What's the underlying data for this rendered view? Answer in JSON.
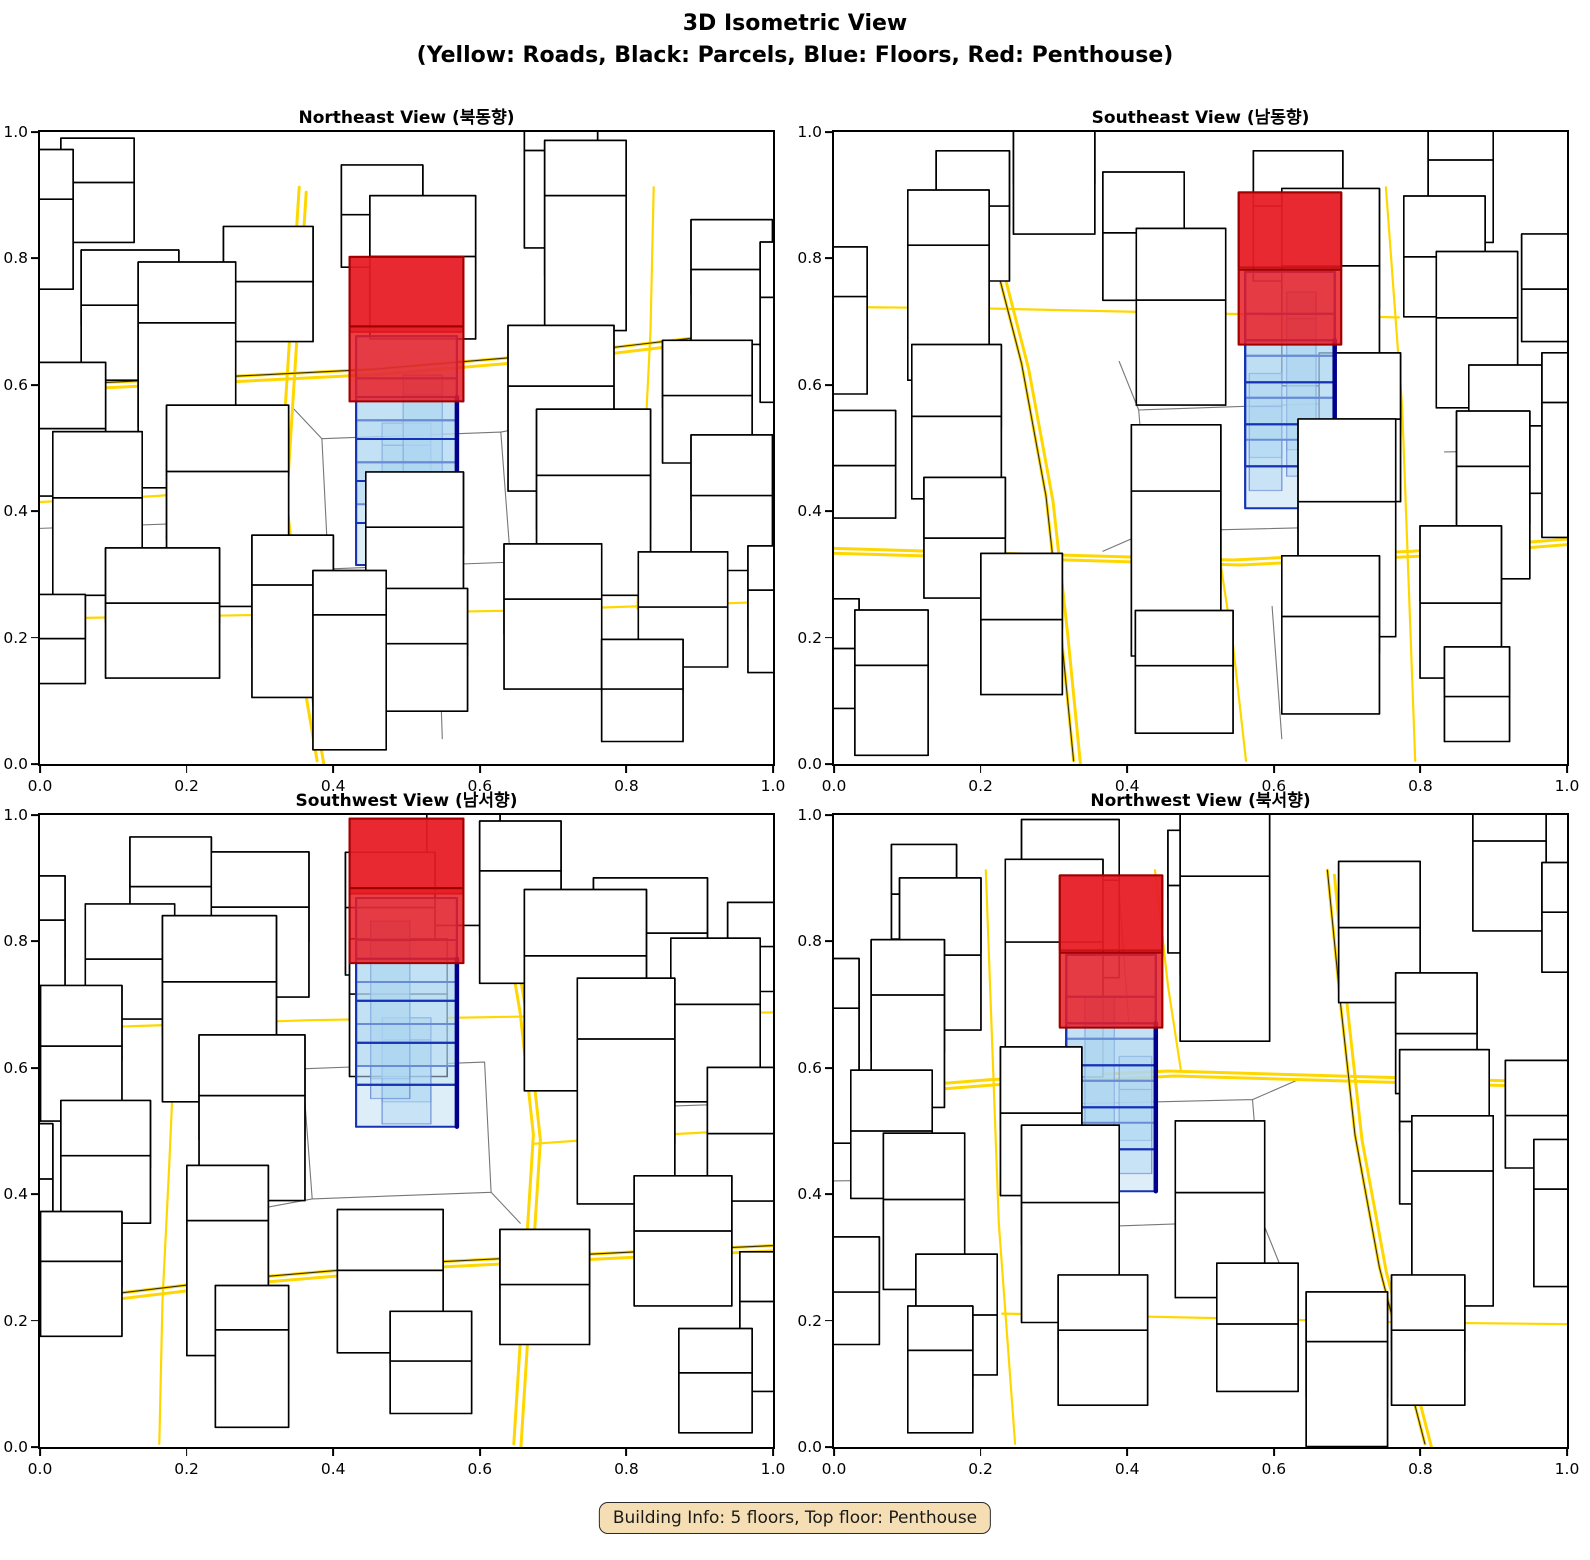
{
  "figure": {
    "suptitle_line1": "3D Isometric View",
    "suptitle_line2": "(Yellow: Roads, Black: Parcels, Blue: Floors, Red: Penthouse)",
    "annotation": "Building Info: 5 floors, Top floor: Penthouse"
  },
  "building_info": {
    "floors": 5,
    "top_floor": "Penthouse"
  },
  "axis": {
    "ticks": [
      "0.0",
      "0.2",
      "0.4",
      "0.6",
      "0.8",
      "1.0"
    ]
  },
  "panels": [
    {
      "id": "northeast",
      "title": "Northeast View (북동향)",
      "azimuth": 45
    },
    {
      "id": "southeast",
      "title": "Southeast View (남동향)",
      "azimuth": 135
    },
    {
      "id": "southwest",
      "title": "Southwest View (남서향)",
      "azimuth": 225
    },
    {
      "id": "northwest",
      "title": "Northwest View (북서향)",
      "azimuth": 315
    }
  ],
  "colors": {
    "road": "#FFD700",
    "parcel": "#777777",
    "parcel_dark": "#3a3000",
    "building_fill": "#ffffff",
    "building_edge": "#000000",
    "floor_fill": "#AED6F1",
    "floor_edge": "#1733B5",
    "floor_edge_dark": "#00008B",
    "penthouse_fill": "#E81C24",
    "penthouse_edge": "#A00000",
    "annotation_bg": "#F5DEB3"
  },
  "scene": {
    "center_building": {
      "x": 0,
      "y": 0.55,
      "w": 0.62,
      "d": 0.55,
      "floors": 4,
      "floor_h": 0.28,
      "pent_h": 0.5,
      "pent_overhang": 0.08
    },
    "annexes": [
      [
        0.0,
        0.4,
        0.3,
        0.2,
        0.56
      ],
      [
        0.1,
        0.62,
        0.24,
        0.18,
        1.05
      ]
    ],
    "buildings": [
      [
        -1.5,
        1.6,
        0.7,
        0.5,
        0.5
      ],
      [
        -0.7,
        1.8,
        0.5,
        0.45,
        0.75
      ],
      [
        0.1,
        1.9,
        0.55,
        0.5,
        0.45
      ],
      [
        0.9,
        1.7,
        0.6,
        0.5,
        0.6
      ],
      [
        1.7,
        1.5,
        0.55,
        0.5,
        0.4
      ],
      [
        -1.9,
        0.8,
        0.55,
        0.6,
        0.65
      ],
      [
        -1.1,
        0.9,
        0.75,
        0.6,
        0.9
      ],
      [
        0.05,
        0.98,
        0.6,
        0.5,
        0.55
      ],
      [
        1.15,
        0.8,
        0.7,
        0.6,
        0.8
      ],
      [
        2.0,
        0.6,
        0.5,
        0.55,
        0.5
      ],
      [
        -2.1,
        -0.1,
        0.5,
        0.6,
        0.45
      ],
      [
        -1.35,
        -0.15,
        0.6,
        0.55,
        1.1
      ],
      [
        0.95,
        -0.12,
        0.65,
        0.55,
        0.7
      ],
      [
        1.85,
        -0.35,
        0.55,
        0.5,
        0.45
      ],
      [
        -1.7,
        -1.1,
        0.6,
        0.5,
        0.5
      ],
      [
        -0.85,
        -1.45,
        0.55,
        0.5,
        0.4
      ],
      [
        0.1,
        -1.5,
        0.65,
        0.55,
        0.55
      ],
      [
        1.1,
        -1.55,
        0.5,
        0.5,
        0.9
      ],
      [
        2.0,
        -1.4,
        0.5,
        0.45,
        0.5
      ],
      [
        -0.15,
        -2.1,
        0.5,
        0.45,
        0.35
      ],
      [
        -2.2,
        1.7,
        0.45,
        0.4,
        0.3
      ],
      [
        2.3,
        1.6,
        0.4,
        0.4,
        0.55
      ],
      [
        -2.3,
        -1.9,
        0.5,
        0.45,
        0.6
      ],
      [
        0.95,
        -2.25,
        0.45,
        0.4,
        0.65
      ],
      [
        -0.35,
        2.3,
        0.45,
        0.4,
        0.9
      ],
      [
        1.45,
        2.2,
        0.5,
        0.45,
        0.35
      ],
      [
        -1.9,
        -2.3,
        0.45,
        0.4,
        0.4
      ],
      [
        2.4,
        -0.9,
        0.45,
        0.5,
        0.7
      ]
    ],
    "roads": [
      {
        "double": true,
        "pts": [
          [
            -2.6,
            -0.78
          ],
          [
            -1.4,
            -0.86
          ],
          [
            -0.2,
            -0.95
          ],
          [
            1.0,
            -1.1
          ],
          [
            2.6,
            -1.38
          ]
        ]
      },
      {
        "double": true,
        "pts": [
          [
            -0.66,
            -2.6
          ],
          [
            -0.72,
            -1.2
          ],
          [
            -0.78,
            0.2
          ],
          [
            -0.7,
            1.3
          ],
          [
            -0.55,
            2.6
          ]
        ]
      },
      {
        "double": false,
        "pts": [
          [
            -2.6,
            1.32
          ],
          [
            -1.0,
            1.28
          ],
          [
            0.6,
            1.24
          ],
          [
            2.6,
            1.14
          ]
        ]
      },
      {
        "double": false,
        "pts": [
          [
            1.52,
            -2.6
          ],
          [
            1.5,
            -1.3
          ],
          [
            1.46,
            -0.1
          ],
          [
            1.42,
            1.22
          ]
        ]
      },
      {
        "double": false,
        "pts": [
          [
            -2.6,
            0.28
          ],
          [
            -1.55,
            0.2
          ],
          [
            -0.78,
            0.12
          ]
        ]
      }
    ],
    "parcels": [
      [
        [
          -0.52,
          -0.32
        ],
        [
          0.58,
          -0.38
        ],
        [
          0.64,
          0.8
        ],
        [
          -0.48,
          0.86
        ],
        [
          -0.52,
          -0.32
        ]
      ],
      [
        [
          -0.52,
          -0.32
        ],
        [
          -0.7,
          -0.6
        ]
      ],
      [
        [
          0.58,
          -0.38
        ],
        [
          1.02,
          -0.5
        ]
      ],
      [
        [
          0.2,
          1.5
        ],
        [
          0.22,
          2.4
        ]
      ],
      [
        [
          -2.4,
          0.5
        ],
        [
          -1.2,
          0.44
        ]
      ]
    ]
  }
}
